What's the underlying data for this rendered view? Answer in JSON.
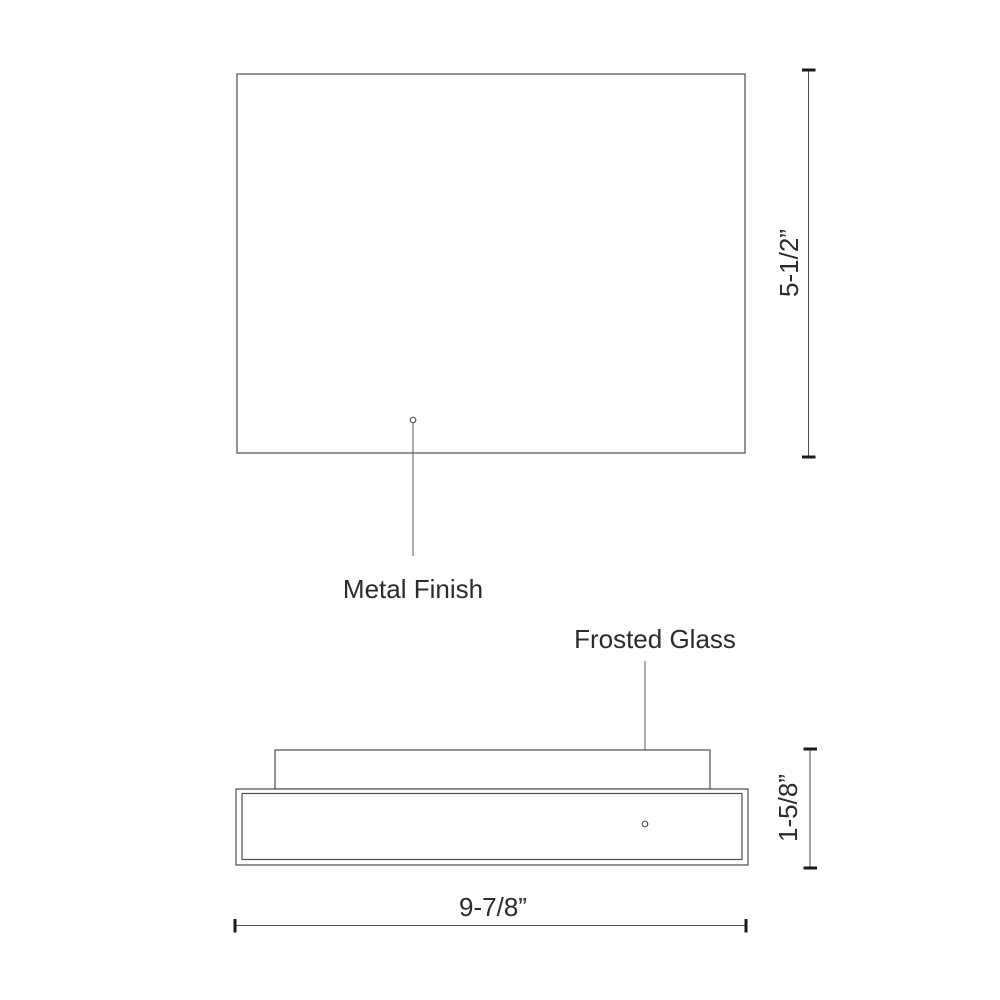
{
  "colors": {
    "background": "#ffffff",
    "line": "#4d4d4d",
    "leader": "#5a5a5a",
    "tick": "#1a1a1a",
    "text": "#2b2b2b"
  },
  "drawing": {
    "type": "technical-line-drawing",
    "subject": "flush-mount-fixture-dimension-diagram",
    "top_view": {
      "callout_metal_finish": "Metal Finish",
      "dim_height": "5-1/2”",
      "marker": "leader-dot-circle"
    },
    "side_view": {
      "callout_frosted_glass": "Frosted Glass",
      "dim_height": "1-5/8”",
      "dim_width": "9-7/8”",
      "marker": "leader-dot-circle"
    }
  }
}
